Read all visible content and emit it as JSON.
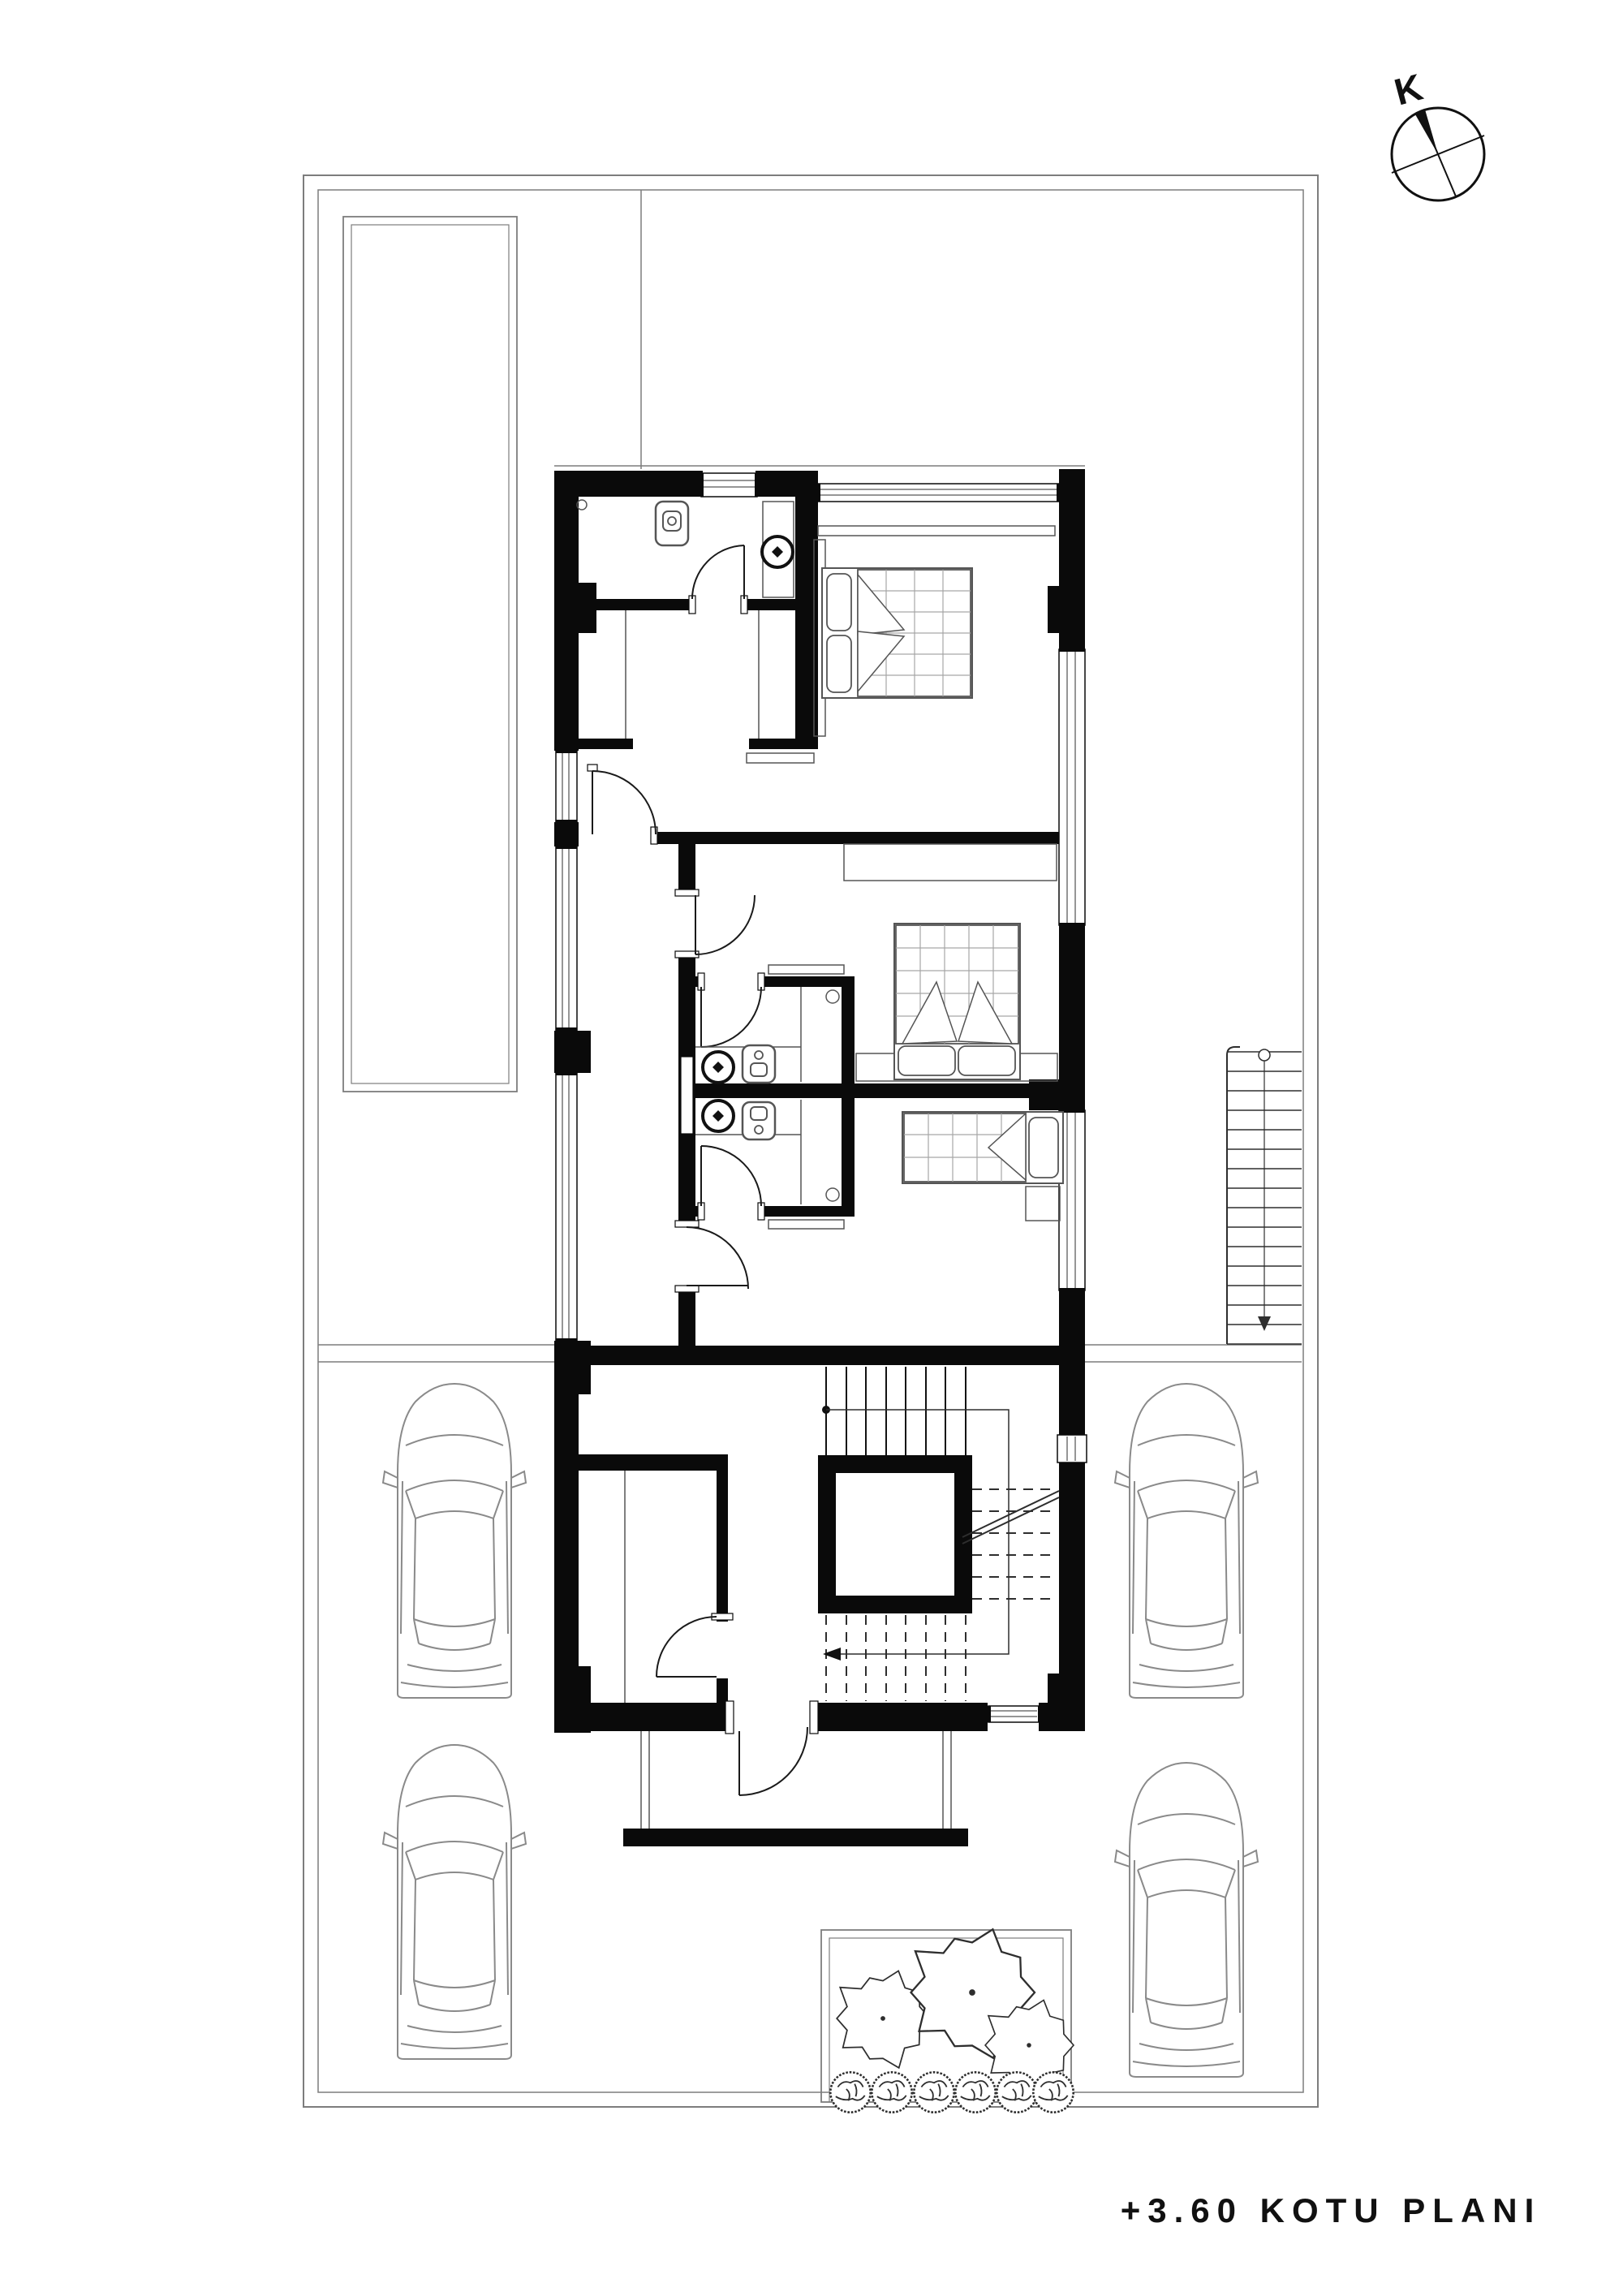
{
  "title": {
    "text": "+3.60 KOTU PLANI"
  },
  "compass": {
    "label": "K",
    "type": "north-arrow"
  },
  "plan": {
    "drawing_type": "architectural-floor-plan",
    "level_label": "+3.60",
    "colors": {
      "wall": "#0a0a0a",
      "line": "#2e2e2e",
      "furniture": "#555555",
      "grid": "#a6a6a6",
      "site": "#7d7d7d",
      "vehicle": "#8a8a8a",
      "background": "#ffffff"
    },
    "counts": {
      "cars": 4,
      "large_trees": 3,
      "shrubs": 6,
      "beds": 3,
      "bathrooms": 3,
      "door_swings": 9,
      "external_stair_treads": 15,
      "internal_stair_treads_solid": 8,
      "internal_stair_treads_dashed": 8
    },
    "features": {
      "elevator": true,
      "pool_terrace": true,
      "entry_porch": true
    }
  }
}
